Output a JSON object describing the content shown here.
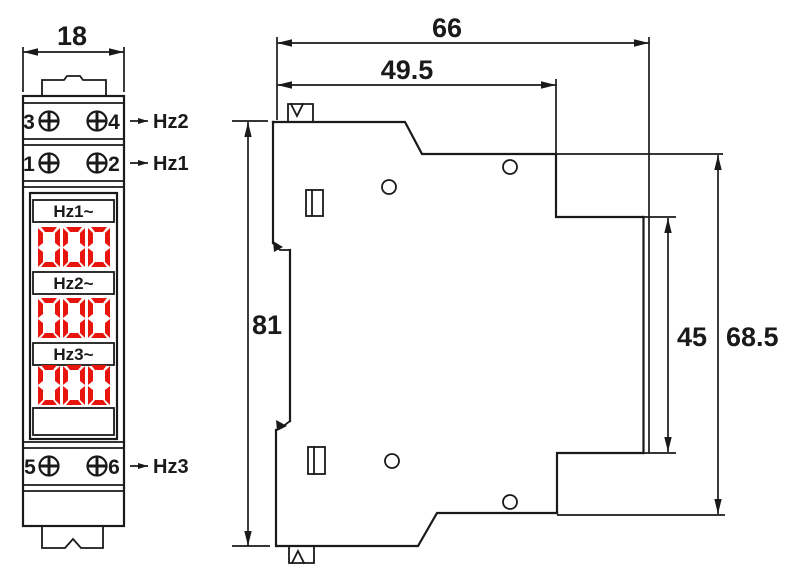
{
  "front_view": {
    "width_dim": "18",
    "terminal_rows": [
      {
        "left": "3",
        "right": "4",
        "signal": "Hz2"
      },
      {
        "left": "1",
        "right": "2",
        "signal": "Hz1"
      },
      {
        "left": "5",
        "right": "6",
        "signal": "Hz3"
      }
    ],
    "display_rows": [
      {
        "label": "Hz1~",
        "value": "000"
      },
      {
        "label": "Hz2~",
        "value": "000"
      },
      {
        "label": "Hz3~",
        "value": "000"
      }
    ]
  },
  "side_view": {
    "dims": {
      "total_depth": "66",
      "front_depth": "49.5",
      "front_height": "81",
      "din_height": "45",
      "rear_height": "68.5"
    }
  },
  "colors": {
    "line": "#1a1a1a",
    "digit_red": "#e8150f"
  }
}
